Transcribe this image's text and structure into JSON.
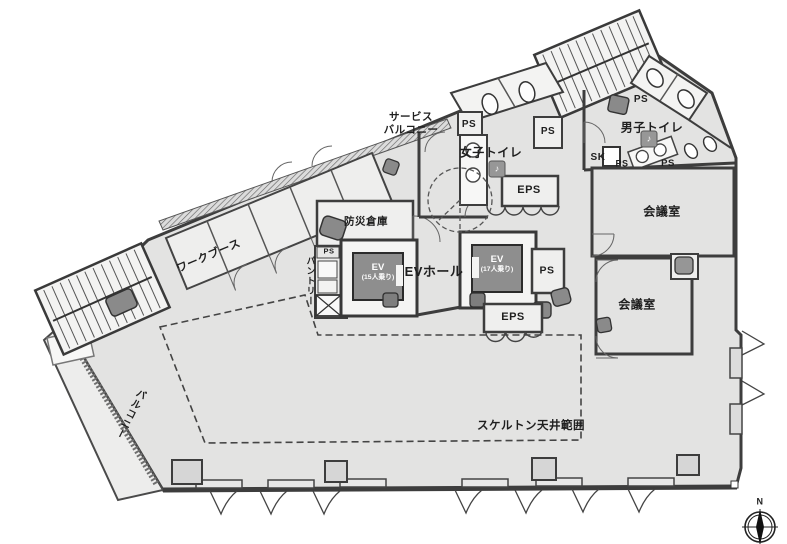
{
  "labels": {
    "service_balcony_line1": "サービス",
    "service_balcony_line2": "バルコニー",
    "womens_toilet": "女子トイレ",
    "mens_toilet": "男子トイレ",
    "disaster_storage": "防災倉庫",
    "pantry": "パントリー",
    "work_booth": "ワークブース",
    "ev": "EV",
    "ev_capacity_15": "(15人乗り)",
    "ev_capacity_17": "(17人乗り)",
    "ev_hall": "EVホール",
    "meeting_room": "会議室",
    "balcony": "バルコニー",
    "skeleton_ceiling_area": "スケルトン天井範囲",
    "ps": "PS",
    "eps": "EPS",
    "sk": "SK",
    "north": "N",
    "music_note_icon": "♪"
  },
  "colors": {
    "background": "#ffffff",
    "floor": "#e3e3e2",
    "wall": "#3d3d3d",
    "elevator_car": "#8e8e8e",
    "equipment": "#8a8a8a",
    "hatch": "#666666"
  }
}
